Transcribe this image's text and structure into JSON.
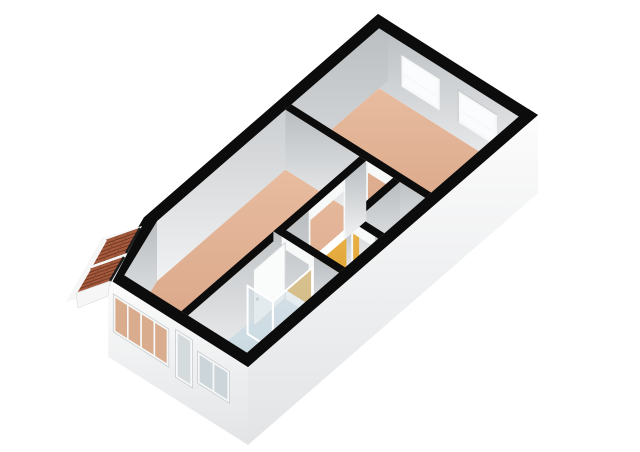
{
  "meta": {
    "description": "3D isometric floor plan render of a one-bedroom apartment",
    "width": 640,
    "height": 452,
    "background": "#ffffff"
  },
  "projection": {
    "origin": [
      378,
      14
    ],
    "u": [
      0.8421,
      0.5316
    ],
    "v": [
      -0.7552,
      0.65625
    ],
    "floor_drop": 60,
    "facade_drop": 78,
    "header_drop": 11,
    "jamb_width": 2.2
  },
  "palette": {
    "wall_top": "#0c0c0c",
    "interior_face_top": "#b9bdc0",
    "interior_face_bottom": "#f1f2f3",
    "exterior_face_top": "#fcfcfc",
    "exterior_face_bottom": "#e2e4e6",
    "floor_tan_light": "#e8bc9f",
    "floor_tan_dark": "#d7a183",
    "floor_yellow_light": "#ecb24a",
    "floor_yellow_dark": "#d89b28",
    "floor_blue_light": "#d6e1e8",
    "floor_blue_dark": "#bfd2da",
    "floor_gray_light": "#ecedee",
    "floor_gray_dark": "#d2d4d5",
    "frame_white": "#f7f8f8",
    "frame_shadow": "#c9cdcf",
    "glass_white": "#fbfcfd",
    "glass_tan": "#d9ac8e",
    "glass_gray": "#d5dadc",
    "glass_blue": "#ccd6da",
    "door_leaf": "#fafbfb",
    "door_edge": "#d4d6d7",
    "glass_shower": "rgba(205,220,228,0.5)",
    "shower_frame": "#ffffff",
    "roof_tile": "#a85a3c",
    "roof_line": "#6f3a26",
    "roof_row_line": "#8a4a30",
    "roof_trim": "#f6f6f6",
    "roof_edge": "#1c1c1c"
  },
  "rooms": [
    {
      "name": "bedroom",
      "floor": "tan",
      "poly": [
        [
          12,
          12
        ],
        [
          178,
          12
        ],
        [
          178,
          128
        ],
        [
          12,
          128
        ]
      ]
    },
    {
      "name": "living-room",
      "floor": "tan",
      "poly": [
        [
          12,
          136
        ],
        [
          100,
          136
        ],
        [
          100,
          372
        ],
        [
          32.3,
          372
        ],
        [
          12,
          306
        ]
      ]
    },
    {
      "name": "hall",
      "floor": "yellow",
      "poly": [
        [
          108,
          136
        ],
        [
          140,
          136
        ],
        [
          140,
          198
        ],
        [
          178,
          198
        ],
        [
          178,
          242
        ],
        [
          108,
          242
        ]
      ]
    },
    {
      "name": "closet",
      "floor": "gray",
      "poly": [
        [
          148,
          136
        ],
        [
          178,
          136
        ],
        [
          178,
          190
        ],
        [
          148,
          190
        ]
      ]
    },
    {
      "name": "bathroom",
      "floor": "blue",
      "poly": [
        [
          108,
          250
        ],
        [
          178,
          250
        ],
        [
          178,
          372
        ],
        [
          108,
          372
        ]
      ]
    }
  ],
  "walls": {
    "back": {
      "ne_face": {
        "name": "outer-wall-ne",
        "edge": [
          [
            0,
            12
          ],
          [
            190,
            12
          ]
        ]
      },
      "nw_face": {
        "name": "outer-wall-nw",
        "edge": [
          [
            12,
            0
          ],
          [
            12,
            310
          ]
        ]
      },
      "chamfer_face": {
        "name": "outer-wall-chamfer",
        "edge": [
          [
            12,
            306
          ],
          [
            36,
            384
          ]
        ]
      },
      "ne_top": [
        [
          0,
          0
        ],
        [
          190,
          0
        ],
        [
          190,
          12
        ],
        [
          0,
          12
        ]
      ],
      "nw_top": [
        [
          0,
          0
        ],
        [
          12,
          0
        ],
        [
          12,
          310
        ],
        [
          0,
          310
        ]
      ],
      "chamfer_top": [
        [
          0,
          310
        ],
        [
          24,
          384
        ],
        [
          36,
          384
        ],
        [
          12,
          306
        ]
      ]
    },
    "inner": [
      {
        "name": "wall-bedroom",
        "axis": "u",
        "rect": [
          12,
          128,
          178,
          136
        ],
        "gaps": [
          [
            110,
            138
          ]
        ]
      },
      {
        "name": "wall-closet-nw",
        "axis": "v",
        "rect": [
          140,
          136,
          148,
          190
        ],
        "gaps": []
      },
      {
        "name": "wall-closet-sw",
        "axis": "u",
        "rect": [
          140,
          190,
          178,
          198
        ],
        "gaps": [
          [
            148,
            172
          ]
        ]
      },
      {
        "name": "wall-living",
        "axis": "v",
        "rect": [
          100,
          136,
          108,
          372
        ],
        "gaps": [
          [
            166,
            210
          ]
        ]
      },
      {
        "name": "wall-bathroom",
        "axis": "u",
        "rect": [
          100,
          242,
          178,
          250
        ],
        "gaps": [
          [
            112,
            146
          ]
        ]
      }
    ],
    "front": {
      "sw_face": {
        "name": "facade-sw",
        "edge": [
          [
            24,
            384
          ],
          [
            190,
            384
          ]
        ]
      },
      "se_face": {
        "name": "facade-se",
        "edge": [
          [
            190,
            0
          ],
          [
            190,
            384
          ]
        ]
      },
      "sw_top": [
        [
          24,
          372
        ],
        [
          190,
          372
        ],
        [
          190,
          384
        ],
        [
          24,
          384
        ]
      ],
      "se_top": [
        [
          178,
          0
        ],
        [
          190,
          0
        ],
        [
          190,
          384
        ],
        [
          178,
          384
        ]
      ]
    }
  },
  "windows": {
    "bedroom": [
      {
        "name": "bedroom-window-1",
        "a1": 38,
        "a2": 84,
        "top": 12,
        "bottom": 44
      },
      {
        "name": "bedroom-window-2",
        "a1": 106,
        "a2": 152,
        "top": 12,
        "bottom": 44
      }
    ],
    "facade": [
      {
        "name": "living-window-row",
        "a1": 30,
        "a2": 96,
        "top": 12,
        "bottom": 50,
        "panes": 4,
        "glass": "glass_tan"
      },
      {
        "name": "garden-door",
        "a1": 104,
        "a2": 124,
        "top": 8,
        "bottom": 56,
        "panes": 1,
        "glass": "glass_gray"
      },
      {
        "name": "bathroom-window",
        "a1": 130,
        "a2": 168,
        "top": 16,
        "bottom": 48,
        "panes": 2,
        "glass": "glass_blue"
      }
    ]
  },
  "fixtures": {
    "bathroom_door": {
      "name": "bathroom-door",
      "plane_a": 114,
      "b1": 250,
      "b2": 292,
      "top": 4
    },
    "shower_panels": [
      {
        "name": "shower-screen-side",
        "axis": "v",
        "a": 146,
        "b1": 250,
        "b2": 302,
        "top": 12
      },
      {
        "name": "shower-screen-front",
        "axis": "u",
        "b": 302,
        "a1": 116,
        "a2": 146,
        "top": 12
      }
    ]
  },
  "roof": {
    "backer": [
      [
        142,
        226
      ],
      [
        102,
        238
      ],
      [
        66,
        302
      ],
      [
        108,
        290
      ]
    ],
    "sections": [
      {
        "poly": [
          [
            140,
            228
          ],
          [
            126,
            253
          ],
          [
            92,
            265
          ],
          [
            106,
            240
          ]
        ],
        "cols": 6,
        "rows": 2
      },
      {
        "poly": [
          [
            124,
            257
          ],
          [
            110,
            281
          ],
          [
            76,
            293
          ],
          [
            90,
            269
          ]
        ],
        "cols": 6,
        "rows": 2
      }
    ],
    "gable": [
      [
        110,
        281
      ],
      [
        76,
        293
      ],
      [
        78,
        308
      ],
      [
        108,
        296
      ]
    ]
  }
}
